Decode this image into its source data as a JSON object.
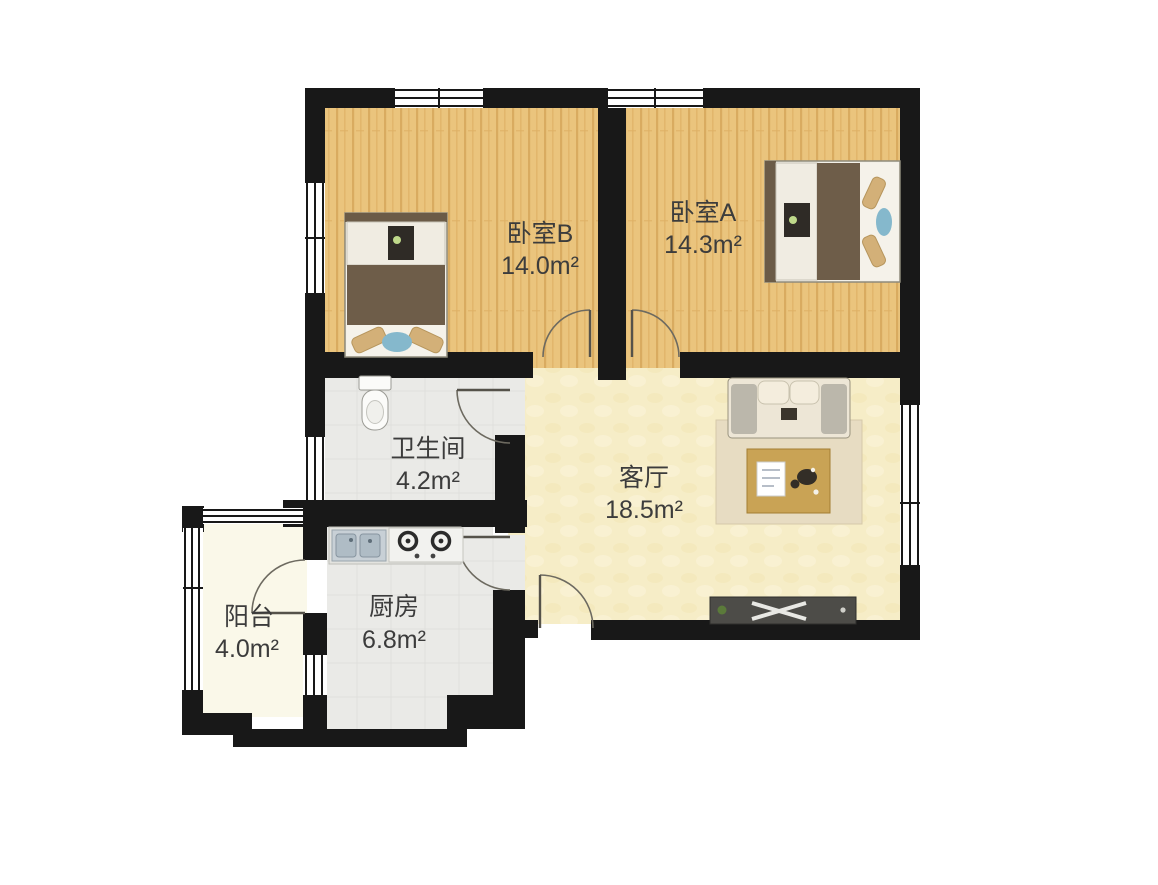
{
  "floorplan": {
    "rooms": [
      {
        "id": "bedroom-b",
        "name": "卧室B",
        "area": "14.0m²"
      },
      {
        "id": "bedroom-a",
        "name": "卧室A",
        "area": "14.3m²"
      },
      {
        "id": "bathroom",
        "name": "卫生间",
        "area": "4.2m²"
      },
      {
        "id": "living-room",
        "name": "客厅",
        "area": "18.5m²"
      },
      {
        "id": "kitchen",
        "name": "厨房",
        "area": "6.8m²"
      },
      {
        "id": "balcony",
        "name": "阳台",
        "area": "4.0m²"
      }
    ],
    "colors": {
      "wall": "#181818",
      "bedroom_floor": "#EAC47D",
      "bedroom_floor_stripe": "#D9AB60",
      "living_floor": "#F6EDC7",
      "bathroom_floor": "#EAEAE7",
      "kitchen_floor": "#EDEDEA",
      "balcony_floor": "#FAF8E9",
      "rug": "#E7DCC2",
      "duvet": "#6E5D49",
      "pillow": "#D3B078",
      "accent_blue": "#85B8CC",
      "table": "#C9A355",
      "tv_stand": "#4D4C48",
      "label_text": "#3C3C3C"
    }
  }
}
